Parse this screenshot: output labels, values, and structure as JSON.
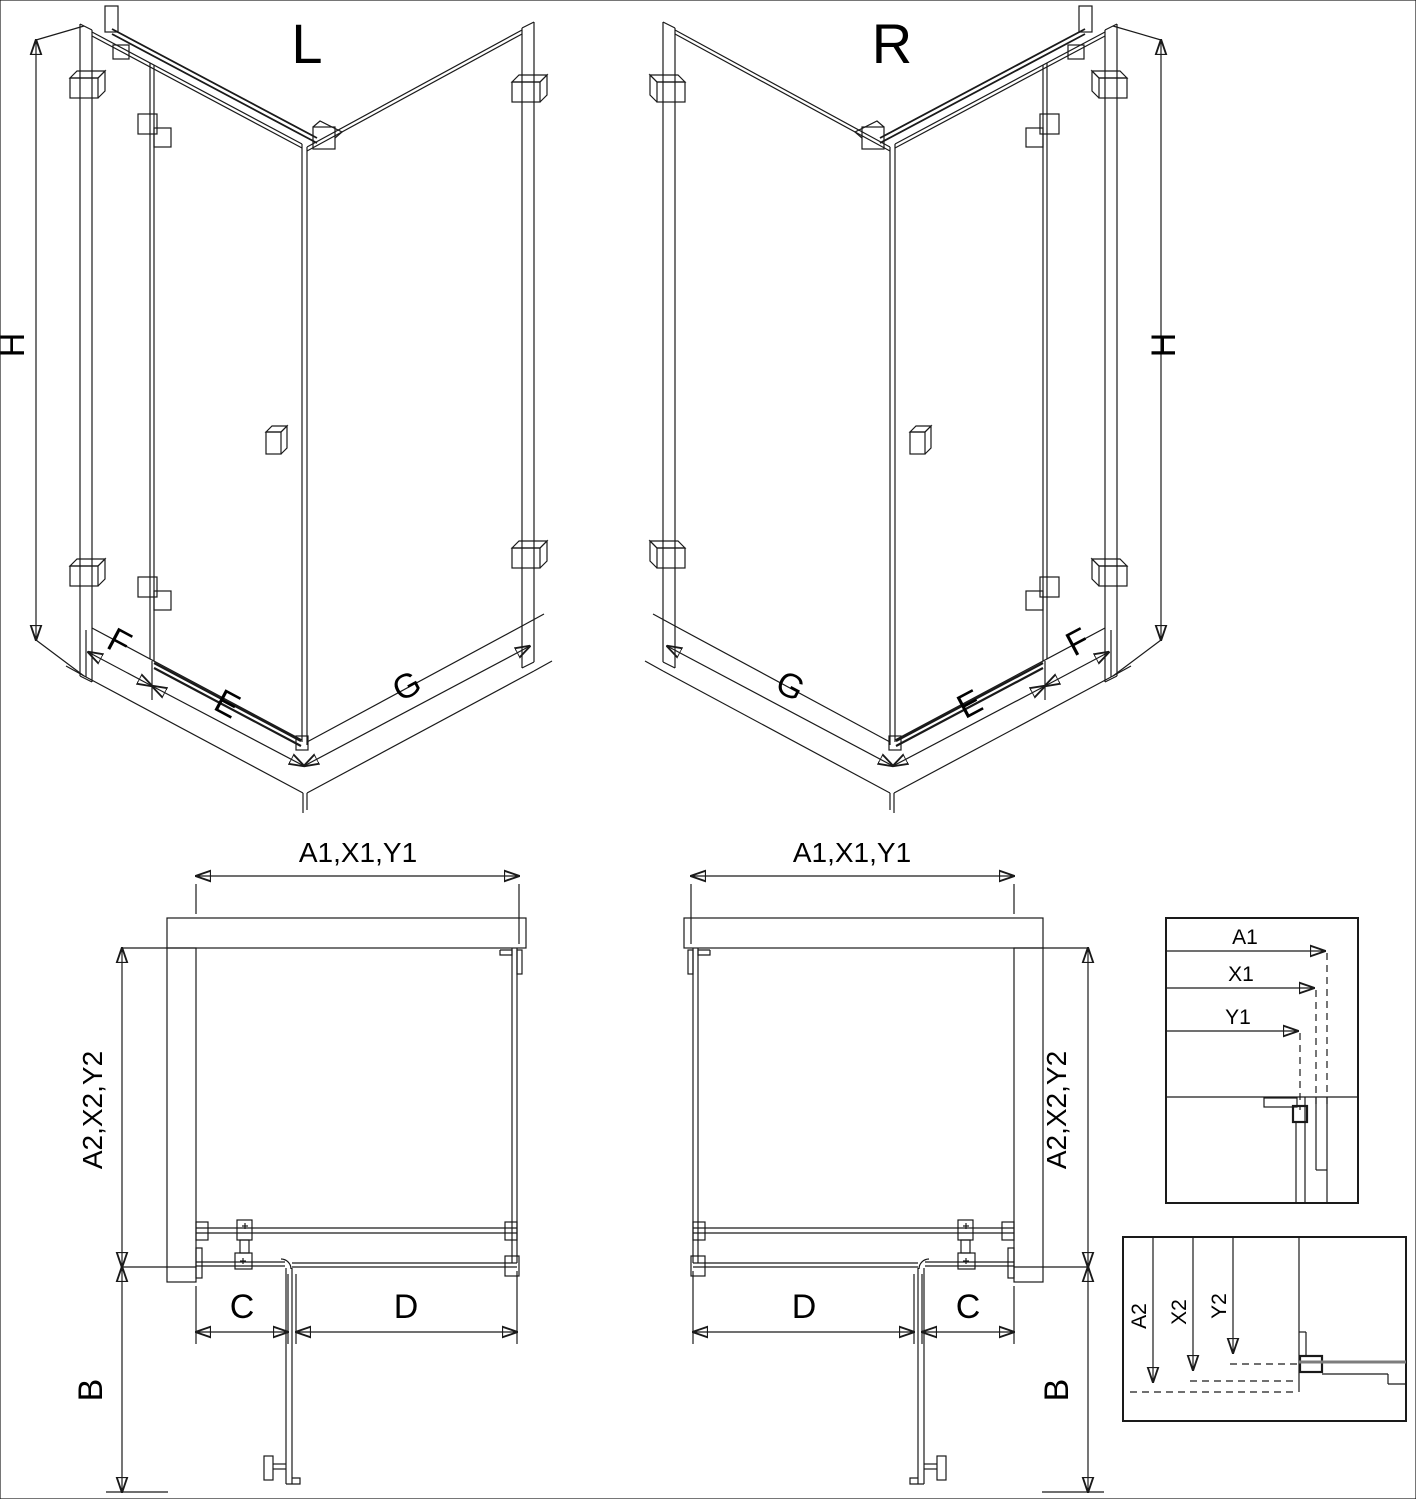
{
  "drawing": {
    "type": "shower-enclosure-technical-drawing",
    "colors": {
      "line": "#1a1a1a",
      "background": "#ffffff",
      "profile_gray": "#7d7d7d"
    },
    "iso_left": {
      "title": "L",
      "height_label": "H",
      "fixed_label": "F",
      "door_label": "E",
      "side_label": "G"
    },
    "iso_right": {
      "title": "R",
      "height_label": "H",
      "fixed_label": "F",
      "door_label": "E",
      "side_label": "G"
    },
    "plan_left": {
      "width_label": "A1,X1,Y1",
      "depth_label": "A2,X2,Y2",
      "door_open_label": "B",
      "fixed_width_label": "C",
      "door_width_label": "D"
    },
    "plan_right": {
      "width_label": "A1,X1,Y1",
      "depth_label": "A2,X2,Y2",
      "door_open_label": "B",
      "fixed_width_label": "C",
      "door_width_label": "D"
    },
    "detail_width": {
      "labels": {
        "a1": "A1",
        "x1": "X1",
        "y1": "Y1"
      }
    },
    "detail_depth": {
      "labels": {
        "a2": "A2",
        "x2": "X2",
        "y2": "Y2"
      }
    }
  }
}
